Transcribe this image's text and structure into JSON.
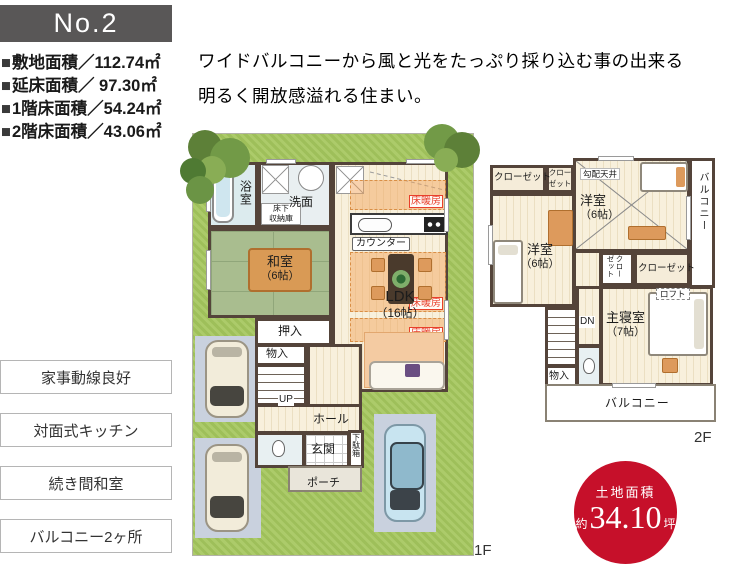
{
  "header": {
    "plan_no": "No.2"
  },
  "specs": [
    {
      "bullet": "■",
      "label": "敷地面積／",
      "value": "112.74㎡"
    },
    {
      "bullet": "■",
      "label": "延床面積／",
      "value": " 97.30㎡"
    },
    {
      "bullet": "■",
      "label": "1階床面積／",
      "value": "54.24㎡"
    },
    {
      "bullet": "■",
      "label": "2階床面積／",
      "value": "43.06㎡"
    }
  ],
  "description": {
    "line1": "ワイドバルコニーから風と光をたっぷり採り込む事の出来る",
    "line2": "明るく開放感溢れる住まい。"
  },
  "features": [
    {
      "label": "家事動線良好"
    },
    {
      "label": "対面式キッチン"
    },
    {
      "label": "続き間和室"
    },
    {
      "label": "バルコニー2ヶ所"
    }
  ],
  "f1": {
    "floor_label": "1F",
    "bath": "浴室",
    "washroom": "洗面",
    "underfloor_line1": "床下",
    "underfloor_line2": "収納庫",
    "floor_heating": "床暖房",
    "counter": "カウンター",
    "japanese_room": "和室",
    "japanese_room_size": "（6帖）",
    "ldk": "LDK",
    "ldk_size": "（16帖）",
    "closet": "押入",
    "storage": "物入",
    "up": "UP",
    "hall": "ホール",
    "entrance": "玄関",
    "shoe_cabinet": "下駄箱",
    "porch": "ポーチ"
  },
  "f2": {
    "floor_label": "2F",
    "closet": "クローゼット",
    "sloped_ceiling": "勾配天井",
    "western_room": "洋室",
    "western_room_size": "（6帖）",
    "master_bedroom": "主寝室",
    "master_bedroom_size": "（7帖）",
    "loft": "ロフト",
    "down": "DN",
    "storage": "物入",
    "balcony": "バルコニー"
  },
  "land_badge": {
    "title": "土地面積",
    "approx": "約",
    "value": "34.10",
    "unit": "坪"
  },
  "colors": {
    "accent_red": "#c6102a",
    "wall": "#54443a",
    "lawn": "#a6c75f",
    "tatami": "#a9bd8f"
  }
}
